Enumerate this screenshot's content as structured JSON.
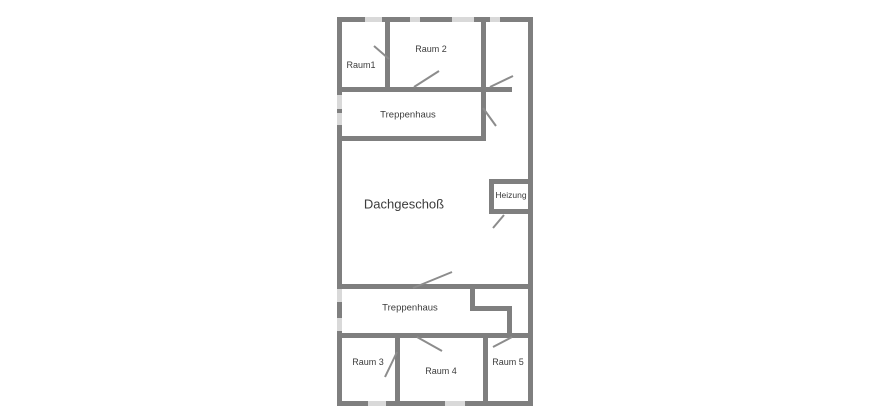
{
  "page": {
    "background_color": "#ffffff"
  },
  "plan": {
    "title": "Dachgeschoß",
    "wall_color": "#7f7f7f",
    "door_color": "#8c8c8c",
    "text_color": "#3c3c3c",
    "watermark_color": "#d9d9d9",
    "bounds": {
      "x": 337,
      "y": 17,
      "w": 196,
      "h": 389
    },
    "walls": [
      {
        "name": "outer-top",
        "x": 337,
        "y": 17,
        "w": 196,
        "h": 5
      },
      {
        "name": "outer-bottom",
        "x": 337,
        "y": 401,
        "w": 196,
        "h": 5
      },
      {
        "name": "outer-left",
        "x": 337,
        "y": 17,
        "w": 5,
        "h": 389
      },
      {
        "name": "outer-right",
        "x": 528,
        "y": 17,
        "w": 5,
        "h": 389
      },
      {
        "name": "raum1-raum2-divider",
        "x": 385,
        "y": 22,
        "w": 5,
        "h": 65
      },
      {
        "name": "below-raum1-raum2",
        "x": 342,
        "y": 87,
        "w": 139,
        "h": 5
      },
      {
        "name": "below-top-right-room",
        "x": 486,
        "y": 87,
        "w": 26,
        "h": 5
      },
      {
        "name": "corridor-left-wall",
        "x": 481,
        "y": 22,
        "w": 5,
        "h": 119
      },
      {
        "name": "treppenhaus-bottom",
        "x": 342,
        "y": 136,
        "w": 139,
        "h": 5
      },
      {
        "name": "heizung-top",
        "x": 489,
        "y": 179,
        "w": 39,
        "h": 5
      },
      {
        "name": "heizung-left",
        "x": 489,
        "y": 184,
        "w": 5,
        "h": 25
      },
      {
        "name": "heizung-bottom",
        "x": 489,
        "y": 209,
        "w": 39,
        "h": 5
      },
      {
        "name": "main-cross-wall",
        "x": 342,
        "y": 284,
        "w": 186,
        "h": 5
      },
      {
        "name": "notch-left-stub",
        "x": 470,
        "y": 289,
        "w": 5,
        "h": 21
      },
      {
        "name": "notch-horizontal",
        "x": 470,
        "y": 306,
        "w": 42,
        "h": 5
      },
      {
        "name": "notch-right-stub",
        "x": 507,
        "y": 311,
        "w": 5,
        "h": 25
      },
      {
        "name": "rooms-top-wall",
        "x": 342,
        "y": 333,
        "w": 186,
        "h": 5
      },
      {
        "name": "raum3-raum4-divider",
        "x": 395,
        "y": 338,
        "w": 5,
        "h": 63
      },
      {
        "name": "raum4-raum5-divider",
        "x": 483,
        "y": 338,
        "w": 5,
        "h": 63
      }
    ],
    "doors": [
      {
        "name": "door-raum1",
        "x1": 374,
        "y1": 46,
        "x2": 389,
        "y2": 59
      },
      {
        "name": "door-raum2",
        "x1": 414,
        "y1": 87,
        "x2": 439,
        "y2": 71
      },
      {
        "name": "door-top-right-room",
        "x1": 490,
        "y1": 87,
        "x2": 513,
        "y2": 76
      },
      {
        "name": "door-corridor",
        "x1": 483,
        "y1": 108,
        "x2": 496,
        "y2": 126
      },
      {
        "name": "door-heizung",
        "x1": 504,
        "y1": 215,
        "x2": 493,
        "y2": 228
      },
      {
        "name": "door-dachgeschoss",
        "x1": 413,
        "y1": 288,
        "x2": 452,
        "y2": 272
      },
      {
        "name": "door-raum3",
        "x1": 385,
        "y1": 377,
        "x2": 397,
        "y2": 352
      },
      {
        "name": "door-raum4",
        "x1": 417,
        "y1": 337,
        "x2": 442,
        "y2": 351
      },
      {
        "name": "door-raum5",
        "x1": 493,
        "y1": 347,
        "x2": 512,
        "y2": 337
      }
    ],
    "labels": [
      {
        "name": "raum1",
        "text": "Raum1",
        "x": 361,
        "y": 65,
        "size": 9
      },
      {
        "name": "raum2",
        "text": "Raum 2",
        "x": 431,
        "y": 49,
        "size": 9
      },
      {
        "name": "treppenhaus-top",
        "text": "Treppenhaus",
        "x": 408,
        "y": 115,
        "size": 9.5
      },
      {
        "name": "dachgeschoss",
        "text": "Dachgeschoß",
        "x": 404,
        "y": 204,
        "size": 13
      },
      {
        "name": "heizung",
        "text": "Heizung",
        "x": 511,
        "y": 195,
        "size": 8.5
      },
      {
        "name": "treppenhaus-bottom",
        "text": "Treppenhaus",
        "x": 410,
        "y": 308,
        "size": 9.5
      },
      {
        "name": "raum3",
        "text": "Raum 3",
        "x": 368,
        "y": 362,
        "size": 9
      },
      {
        "name": "raum4",
        "text": "Raum 4",
        "x": 441,
        "y": 371,
        "size": 9
      },
      {
        "name": "raum5",
        "text": "Raum 5",
        "x": 508,
        "y": 362,
        "size": 9
      }
    ],
    "watermarks": [
      {
        "name": "wm-top-1",
        "x": 365,
        "y": 17,
        "w": 17,
        "h": 5
      },
      {
        "name": "wm-top-2",
        "x": 410,
        "y": 17,
        "w": 10,
        "h": 5
      },
      {
        "name": "wm-top-3",
        "x": 452,
        "y": 17,
        "w": 22,
        "h": 5
      },
      {
        "name": "wm-top-4",
        "x": 490,
        "y": 17,
        "w": 10,
        "h": 5
      },
      {
        "name": "wm-left-1",
        "x": 337,
        "y": 95,
        "w": 5,
        "h": 14
      },
      {
        "name": "wm-left-2",
        "x": 337,
        "y": 113,
        "w": 5,
        "h": 12
      },
      {
        "name": "wm-left-3",
        "x": 337,
        "y": 289,
        "w": 5,
        "h": 13
      },
      {
        "name": "wm-left-4",
        "x": 337,
        "y": 318,
        "w": 5,
        "h": 13
      },
      {
        "name": "wm-bottom-1",
        "x": 368,
        "y": 401,
        "w": 18,
        "h": 5
      },
      {
        "name": "wm-bottom-2",
        "x": 445,
        "y": 401,
        "w": 20,
        "h": 5
      }
    ]
  }
}
